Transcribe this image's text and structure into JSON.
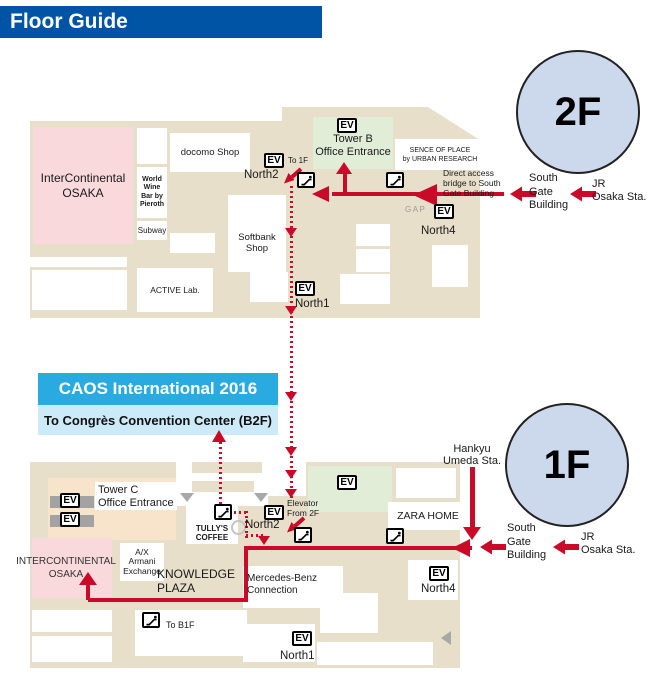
{
  "header": {
    "title": "Floor Guide"
  },
  "banner": {
    "title": "CAOS International 2016",
    "subtitle": "To Congrès Convention Center (B2F)"
  },
  "ev": "EV",
  "colors": {
    "header_blue": "#0054a5",
    "route_red": "#c90a28",
    "banner_cyan": "#29abe2",
    "banner_light": "#cdeaf8",
    "circle_fill": "#ccd8ec",
    "map_beige": "#e7dfca",
    "room_pink": "#f9d9dc",
    "room_peach": "#f8e4ca",
    "room_green": "#e2edd8",
    "bar_gray": "#a3a3a3"
  },
  "floor2": {
    "badge": "2F",
    "intercontinental": "InterContinental\nOSAKA",
    "world_wine_bar": "World\nWine\nBar by\nPieroth",
    "subway": "Subway",
    "docomo": "docomo Shop",
    "tower_b": "Tower B\nOffice Entrance",
    "sence_of_place": "SENCE OF PLACE\nby URBAN RESEARCH",
    "softbank": "Softbank\nShop",
    "active_lab": "ACTIVE Lab.",
    "gap": "GAP",
    "to_1f": "To 1F",
    "north1": "North1",
    "north2": "North2",
    "north4": "North4",
    "direct_access": "Direct access\nbridge to South\nGate Building",
    "south_gate": "South\nGate\nBuilding",
    "jr": "JR\nOsaka Sta."
  },
  "floor1": {
    "badge": "1F",
    "tower_c": "Tower C\nOffice Entrance",
    "tullys": "TULLY'S\nCOFFEE",
    "intercontinental": "INTERCONTINENTAL\nOSAKA",
    "armani": "A/X\nArmani\nExchange",
    "knowledge": "KNOWLEDGE\nPLAZA",
    "zara": "ZARA HOME",
    "mercedes": "Mercedes-Benz\nConnection",
    "to_b1f": "To B1F",
    "elevator_from_2f": "Elevator\nFrom 2F",
    "north1": "North1",
    "north2": "North2",
    "north4": "North4",
    "hankyu": "Hankyu\nUmeda Sta.",
    "south_gate": "South\nGate\nBuilding",
    "jr": "JR\nOsaka Sta."
  }
}
